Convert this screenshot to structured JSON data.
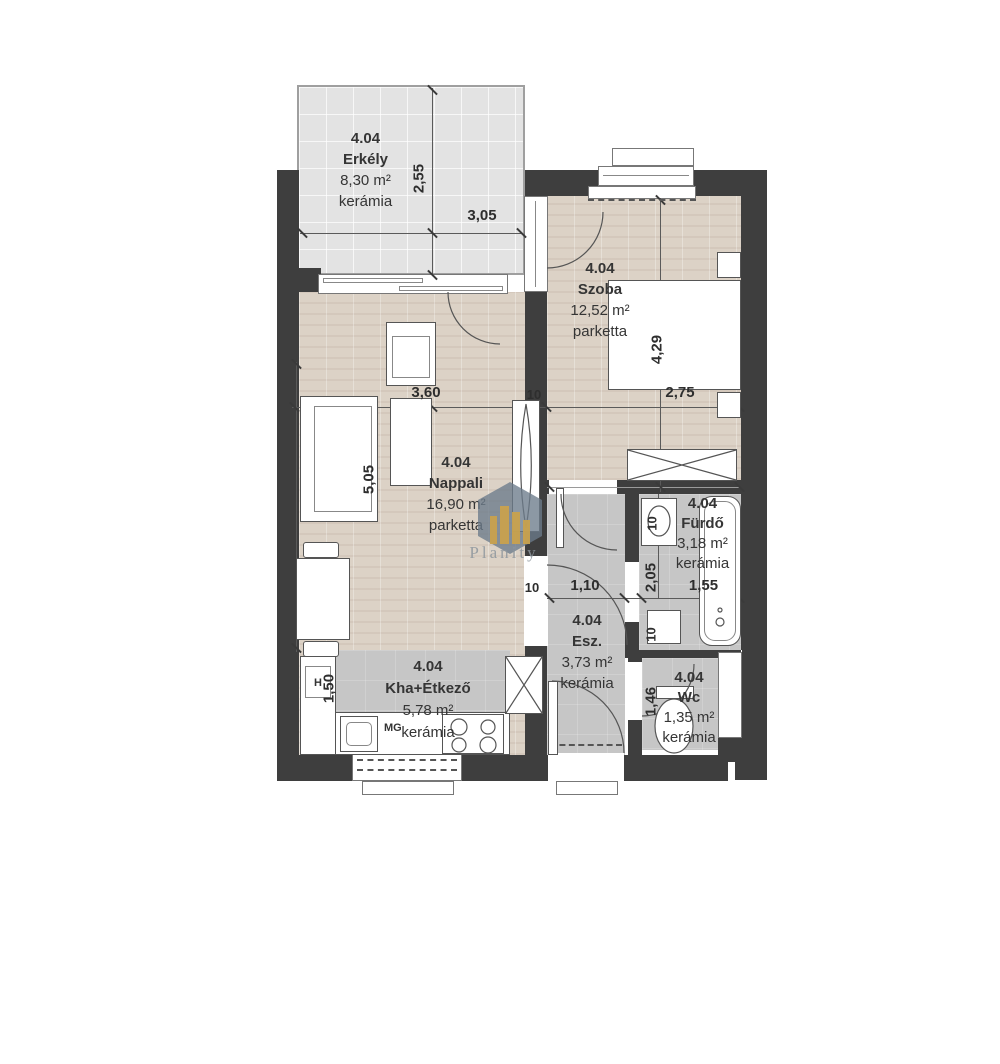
{
  "meta": {
    "type": "apartment-floor-plan",
    "unit": "4.04"
  },
  "watermark": {
    "brand": "Planity"
  },
  "rooms": {
    "erkely": {
      "id": "4.04",
      "name": "Erkély",
      "area": "8,30 m²",
      "floor": "kerámia"
    },
    "szoba": {
      "id": "4.04",
      "name": "Szoba",
      "area": "12,52 m²",
      "floor": "parketta"
    },
    "nappali": {
      "id": "4.04",
      "name": "Nappali",
      "area": "16,90 m²",
      "floor": "parketta"
    },
    "furdo": {
      "id": "4.04",
      "name": "Fürdő",
      "area": "3,18 m²",
      "floor": "kerámia"
    },
    "esz": {
      "id": "4.04",
      "name": "Esz.",
      "area": "3,73 m²",
      "floor": "kerámia"
    },
    "konyha": {
      "id": "4.04",
      "name": "Kha+Étkező",
      "area": "5,78 m²",
      "floor": "kerámia"
    },
    "wc": {
      "id": "4.04",
      "name": "Wc",
      "area": "1,35 m²",
      "floor": "kerámia"
    }
  },
  "dimensions": {
    "balcony_height": "2,55",
    "balcony_width": "3,05",
    "nappali_width": "3,60",
    "szoba_width": "2,75",
    "szoba_height": "4,29",
    "nappali_height": "5,05",
    "hall_width": "1,10",
    "furdo_height": "2,05",
    "furdo_width": "1,55",
    "kitchen_depth": "1,50",
    "wc_height": "1,46",
    "wall_a": "10",
    "wall_b": "10",
    "wall_c": "10",
    "wall_d": "10"
  },
  "appliance_labels": {
    "dishwasher": "MG",
    "hood": "H"
  },
  "colors": {
    "wall": "#3e3e3e",
    "parquet": "#dcd2c6",
    "ceramic_tile": "#c6c6c6",
    "balcony_tile": "#e3e3e3",
    "watermark_hex": "#6b7b8a",
    "watermark_gold": "#c9a24e"
  }
}
